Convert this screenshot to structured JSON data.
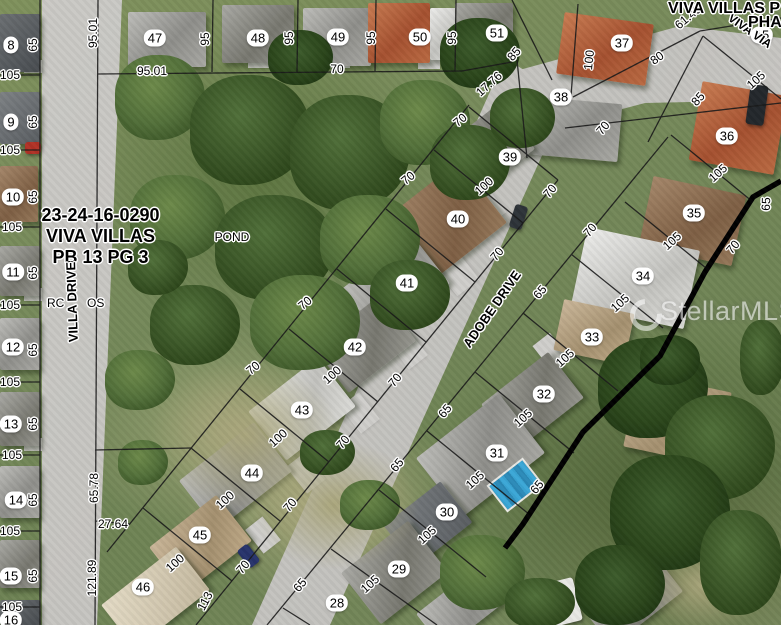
{
  "map_labels": {
    "plat_line1": "23-24-16-0290",
    "plat_line2": "VIVA VILLAS",
    "plat_line3": "PB 13 PG 3",
    "pond": "POND",
    "street_villa": "VILLA DRIVE",
    "street_adobe": "ADOBE DRIVE",
    "street_viva_via": "VIVA VIA",
    "row_fragment_left": "RC",
    "row_fragment_right": "OS",
    "top_right_line1": "VIVA VILLAS P",
    "top_right_line2": "PHA",
    "watermark": "StellarMLS"
  },
  "parcels": [
    {
      "n": "8",
      "x": 11,
      "y": 45
    },
    {
      "n": "9",
      "x": 11,
      "y": 122
    },
    {
      "n": "10",
      "x": 13,
      "y": 197
    },
    {
      "n": "11",
      "x": 13,
      "y": 272
    },
    {
      "n": "12",
      "x": 13,
      "y": 347
    },
    {
      "n": "13",
      "x": 11,
      "y": 424
    },
    {
      "n": "14",
      "x": 16,
      "y": 500
    },
    {
      "n": "15",
      "x": 11,
      "y": 576
    },
    {
      "n": "16",
      "x": 11,
      "y": 620
    },
    {
      "n": "47",
      "x": 155,
      "y": 38
    },
    {
      "n": "48",
      "x": 258,
      "y": 38
    },
    {
      "n": "49",
      "x": 338,
      "y": 37
    },
    {
      "n": "50",
      "x": 420,
      "y": 37
    },
    {
      "n": "51",
      "x": 497,
      "y": 33
    },
    {
      "n": "37",
      "x": 622,
      "y": 43
    },
    {
      "n": "38",
      "x": 561,
      "y": 97
    },
    {
      "n": "15",
      "x": 762,
      "y": 35
    },
    {
      "n": "36",
      "x": 727,
      "y": 136
    },
    {
      "n": "39",
      "x": 510,
      "y": 157
    },
    {
      "n": "35",
      "x": 694,
      "y": 213
    },
    {
      "n": "40",
      "x": 458,
      "y": 219
    },
    {
      "n": "34",
      "x": 643,
      "y": 276
    },
    {
      "n": "41",
      "x": 407,
      "y": 283
    },
    {
      "n": "33",
      "x": 592,
      "y": 337
    },
    {
      "n": "42",
      "x": 355,
      "y": 347
    },
    {
      "n": "32",
      "x": 544,
      "y": 394
    },
    {
      "n": "43",
      "x": 302,
      "y": 410
    },
    {
      "n": "31",
      "x": 497,
      "y": 453
    },
    {
      "n": "44",
      "x": 252,
      "y": 473
    },
    {
      "n": "30",
      "x": 447,
      "y": 512
    },
    {
      "n": "45",
      "x": 200,
      "y": 535
    },
    {
      "n": "29",
      "x": 399,
      "y": 569
    },
    {
      "n": "46",
      "x": 143,
      "y": 587
    },
    {
      "n": "28",
      "x": 337,
      "y": 603
    }
  ],
  "dimensions": [
    {
      "t": "95.01",
      "x": 93,
      "y": 33,
      "r": -90
    },
    {
      "t": "95.01",
      "x": 152,
      "y": 71,
      "r": 0
    },
    {
      "t": "95",
      "x": 205,
      "y": 39,
      "r": -90
    },
    {
      "t": "95",
      "x": 289,
      "y": 38,
      "r": -90
    },
    {
      "t": "95",
      "x": 371,
      "y": 38,
      "r": -90
    },
    {
      "t": "95",
      "x": 452,
      "y": 38,
      "r": -90
    },
    {
      "t": "70",
      "x": 337,
      "y": 69,
      "r": 0
    },
    {
      "t": "17.76",
      "x": 489,
      "y": 84,
      "r": -42
    },
    {
      "t": "85",
      "x": 514,
      "y": 54,
      "r": -48
    },
    {
      "t": "100",
      "x": 589,
      "y": 60,
      "r": -84
    },
    {
      "t": "80",
      "x": 657,
      "y": 58,
      "r": -35
    },
    {
      "t": "61.49",
      "x": 688,
      "y": 17,
      "r": -40
    },
    {
      "t": "85",
      "x": 698,
      "y": 99,
      "r": -48
    },
    {
      "t": "105",
      "x": 756,
      "y": 80,
      "r": -42
    },
    {
      "t": "70",
      "x": 603,
      "y": 128,
      "r": -50
    },
    {
      "t": "70",
      "x": 460,
      "y": 120,
      "r": -40
    },
    {
      "t": "100",
      "x": 484,
      "y": 186,
      "r": -42
    },
    {
      "t": "70",
      "x": 550,
      "y": 191,
      "r": -50
    },
    {
      "t": "70",
      "x": 408,
      "y": 178,
      "r": -40
    },
    {
      "t": "65",
      "x": 766,
      "y": 204,
      "r": -88
    },
    {
      "t": "105",
      "x": 718,
      "y": 173,
      "r": -42
    },
    {
      "t": "70",
      "x": 733,
      "y": 247,
      "r": -50
    },
    {
      "t": "105",
      "x": 672,
      "y": 241,
      "r": -42
    },
    {
      "t": "70",
      "x": 590,
      "y": 230,
      "r": -50
    },
    {
      "t": "70",
      "x": 497,
      "y": 254,
      "r": -50
    },
    {
      "t": "65",
      "x": 540,
      "y": 292,
      "r": -50
    },
    {
      "t": "105",
      "x": 620,
      "y": 303,
      "r": -42
    },
    {
      "t": "70",
      "x": 305,
      "y": 303,
      "r": -40
    },
    {
      "t": "70",
      "x": 253,
      "y": 368,
      "r": -40
    },
    {
      "t": "100",
      "x": 332,
      "y": 375,
      "r": -42
    },
    {
      "t": "70",
      "x": 395,
      "y": 380,
      "r": -50
    },
    {
      "t": "105",
      "x": 565,
      "y": 358,
      "r": -42
    },
    {
      "t": "65",
      "x": 445,
      "y": 411,
      "r": -50
    },
    {
      "t": "105",
      "x": 523,
      "y": 418,
      "r": -42
    },
    {
      "t": "100",
      "x": 278,
      "y": 438,
      "r": -42
    },
    {
      "t": "70",
      "x": 343,
      "y": 442,
      "r": -50
    },
    {
      "t": "65",
      "x": 537,
      "y": 487,
      "r": -50
    },
    {
      "t": "105",
      "x": 475,
      "y": 480,
      "r": -42
    },
    {
      "t": "65",
      "x": 397,
      "y": 465,
      "r": -50
    },
    {
      "t": "100",
      "x": 225,
      "y": 500,
      "r": -42
    },
    {
      "t": "70",
      "x": 290,
      "y": 505,
      "r": -50
    },
    {
      "t": "27.64",
      "x": 113,
      "y": 524,
      "r": 0
    },
    {
      "t": "65.78",
      "x": 94,
      "y": 488,
      "r": -90
    },
    {
      "t": "121.89",
      "x": 92,
      "y": 578,
      "r": -90
    },
    {
      "t": "100",
      "x": 175,
      "y": 563,
      "r": -42
    },
    {
      "t": "113",
      "x": 205,
      "y": 601,
      "r": -62
    },
    {
      "t": "70",
      "x": 243,
      "y": 567,
      "r": -50
    },
    {
      "t": "65",
      "x": 300,
      "y": 585,
      "r": -50
    },
    {
      "t": "105",
      "x": 370,
      "y": 584,
      "r": -42
    },
    {
      "t": "105",
      "x": 427,
      "y": 535,
      "r": -42
    },
    {
      "t": "65",
      "x": 33,
      "y": 45,
      "r": -90
    },
    {
      "t": "65",
      "x": 33,
      "y": 122,
      "r": -90
    },
    {
      "t": "65",
      "x": 33,
      "y": 197,
      "r": -90
    },
    {
      "t": "65",
      "x": 33,
      "y": 273,
      "r": -90
    },
    {
      "t": "65",
      "x": 33,
      "y": 350,
      "r": -90
    },
    {
      "t": "65",
      "x": 33,
      "y": 424,
      "r": -90
    },
    {
      "t": "65",
      "x": 33,
      "y": 500,
      "r": -90
    },
    {
      "t": "65",
      "x": 33,
      "y": 576,
      "r": -90
    },
    {
      "t": "105",
      "x": 10,
      "y": 75,
      "r": 0
    },
    {
      "t": "105",
      "x": 10,
      "y": 150,
      "r": 0
    },
    {
      "t": "105",
      "x": 12,
      "y": 227,
      "r": 0
    },
    {
      "t": "105",
      "x": 10,
      "y": 305,
      "r": 0
    },
    {
      "t": "105",
      "x": 10,
      "y": 382,
      "r": 0
    },
    {
      "t": "105",
      "x": 12,
      "y": 455,
      "r": 0
    },
    {
      "t": "105",
      "x": 10,
      "y": 531,
      "r": 0
    },
    {
      "t": "105",
      "x": 12,
      "y": 607,
      "r": 0
    }
  ]
}
